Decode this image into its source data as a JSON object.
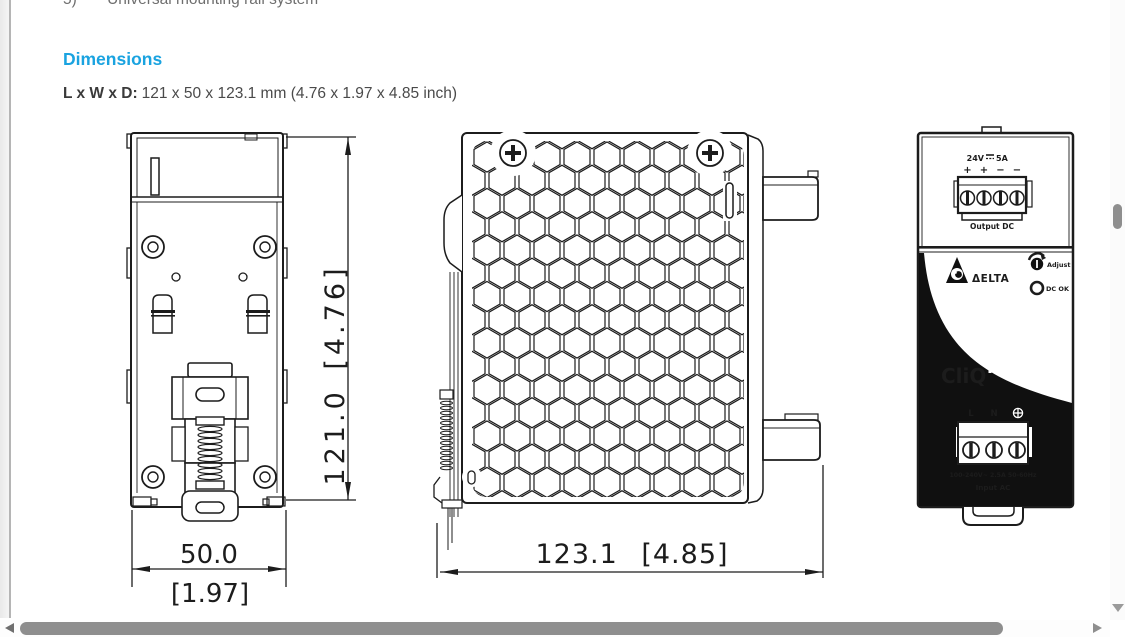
{
  "document": {
    "clipped_top_line": {
      "number": "5)",
      "text": "Universal mounting rail system"
    },
    "heading": "Dimensions",
    "size_label": "L x W x D:",
    "size_value": "121 x 50 x 123.1 mm (4.76 x 1.97 x 4.85 inch)"
  },
  "back_view": {
    "height_dim": "121.0 [4.76]",
    "width_dim_mm": "50.0",
    "width_dim_inch": "[1.97]"
  },
  "side_view": {
    "depth_dim": "123.1 [4.85]"
  },
  "front_view": {
    "output_voltage": "24V",
    "output_current": "5A",
    "output_polarity": [
      "+",
      "+",
      "−",
      "−"
    ],
    "output_label": "Output DC",
    "brand": "ΔELTA",
    "adjust_label": "Adjust",
    "dc_ok_label": "DC OK",
    "product_line": "CliQ",
    "input_terminal_l": "L",
    "input_terminal_n": "N",
    "input_rating": "100-240V~ 2.5A 50-60Hz",
    "input_label": "Input AC"
  },
  "ui": {
    "accent_color": "#1AA3E0",
    "scrollbar_thumb_color": "#8E8E8E",
    "line_color": "#1C1C1C"
  }
}
